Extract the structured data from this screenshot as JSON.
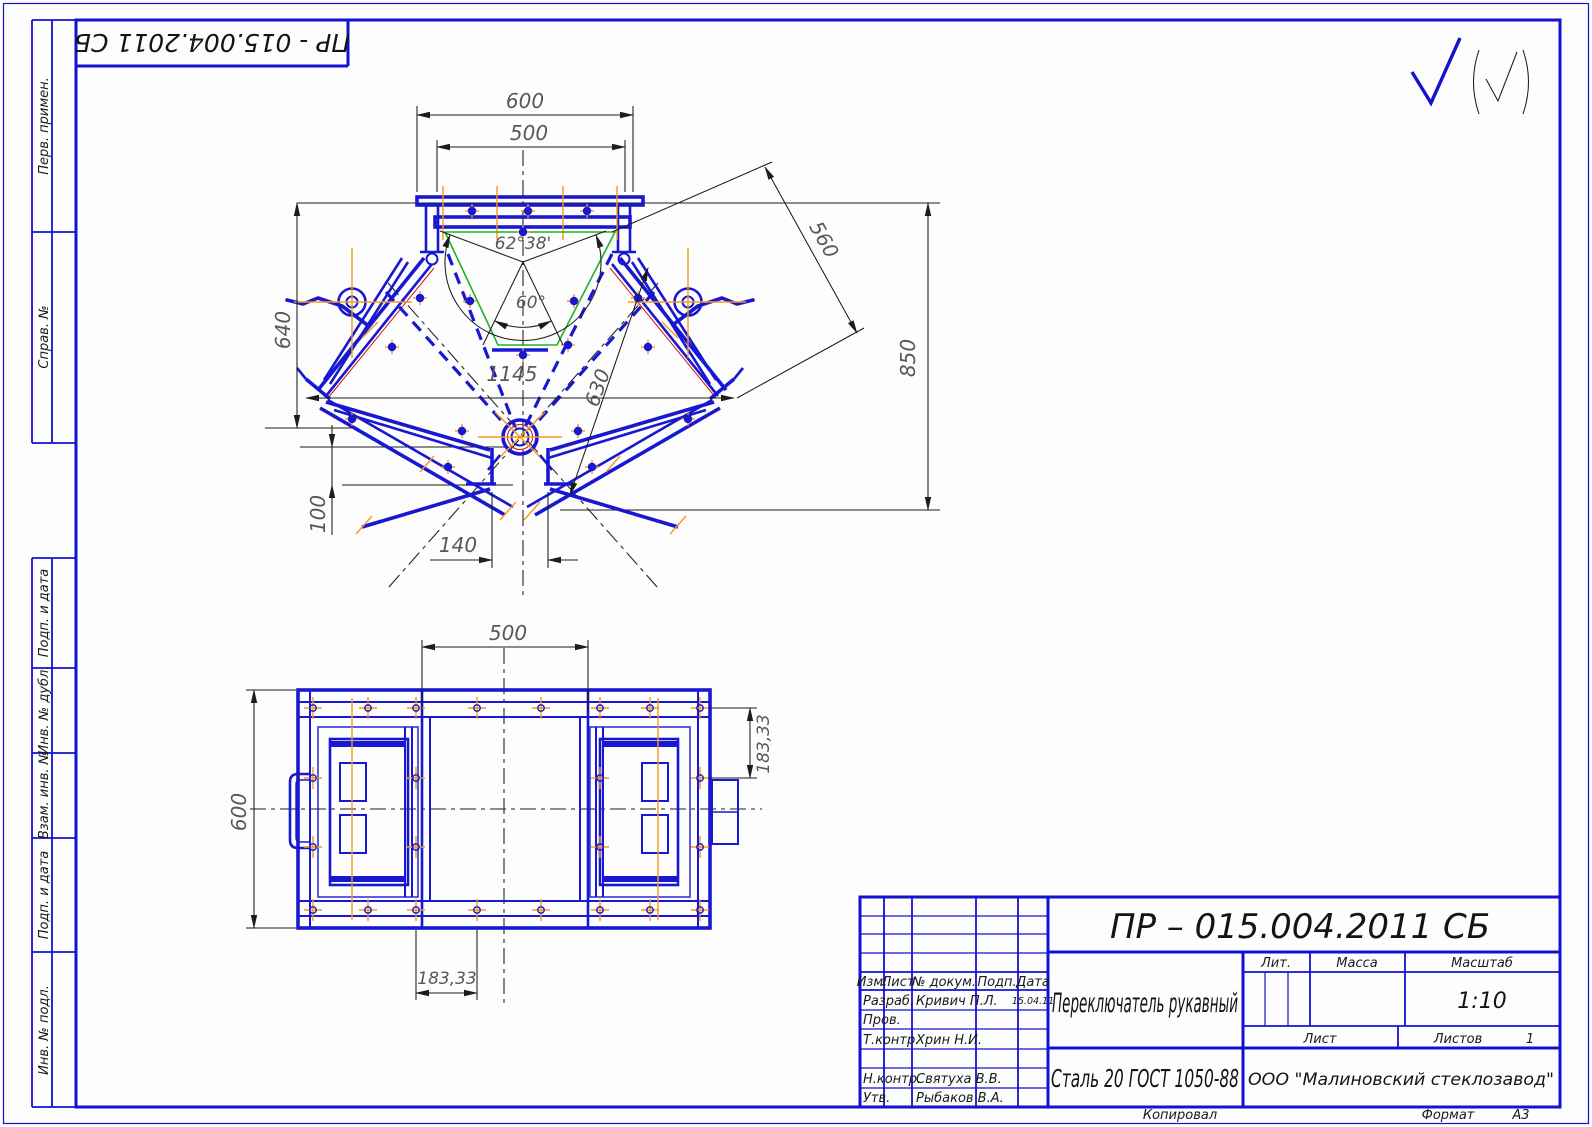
{
  "document": {
    "stamp_rotated": "ПР - 015.004.2011 СБ",
    "margin_labels": {
      "perv": "Перв. примен.",
      "sprav": "Справ. №",
      "podp1": "Подп. и дата",
      "inv_dubl": "Инв. № дубл.",
      "vzam": "Взам. инв. №",
      "podp2": "Подп. и дата",
      "inv_podl": "Инв. № подл."
    }
  },
  "icons": {
    "roughness_general": "check-mark",
    "roughness_reference": "check-mark-in-parentheses"
  },
  "main_view": {
    "dims": {
      "w600": "600",
      "w500": "500",
      "ang6238": "62°38'",
      "ang60": "60°",
      "w1145": "1145",
      "len630": "630",
      "h640": "640",
      "len560": "560",
      "h850": "850",
      "h100": "100",
      "w140": "140"
    }
  },
  "plan_view": {
    "dims": {
      "w500": "500",
      "h600": "600",
      "p183r": "183,33",
      "p183b": "183,33"
    }
  },
  "title_block": {
    "doc_number": "ПР – 015.004.2011 СБ",
    "name": "Переключатель рукавный",
    "material": "Сталь 20 ГОСТ 1050-88",
    "company": "ООО \"Малиновский стеклозавод\"",
    "scale": "1:10",
    "sheets": "1",
    "headers": {
      "izm": "Изм.",
      "list": "Лист",
      "dokum": "№ докум.",
      "podp": "Подп.",
      "data": "Дата",
      "lit": "Лит.",
      "massa": "Масса",
      "masshtab": "Масштаб",
      "list2": "Лист",
      "listov": "Листов"
    },
    "rows": [
      {
        "role": "Разраб.",
        "name": "Кривич П.Л.",
        "date": "15.04.11"
      },
      {
        "role": "Пров.",
        "name": "",
        "date": ""
      },
      {
        "role": "Т.контр.",
        "name": "Хрин Н.И.",
        "date": ""
      },
      {
        "role": "Н.контр.",
        "name": "Святуха В.В.",
        "date": ""
      },
      {
        "role": "Утв.",
        "name": "Рыбаков В.А.",
        "date": ""
      }
    ],
    "footer": {
      "kopiroval": "Копировал",
      "format_label": "Формат",
      "format_value": "А3"
    }
  }
}
